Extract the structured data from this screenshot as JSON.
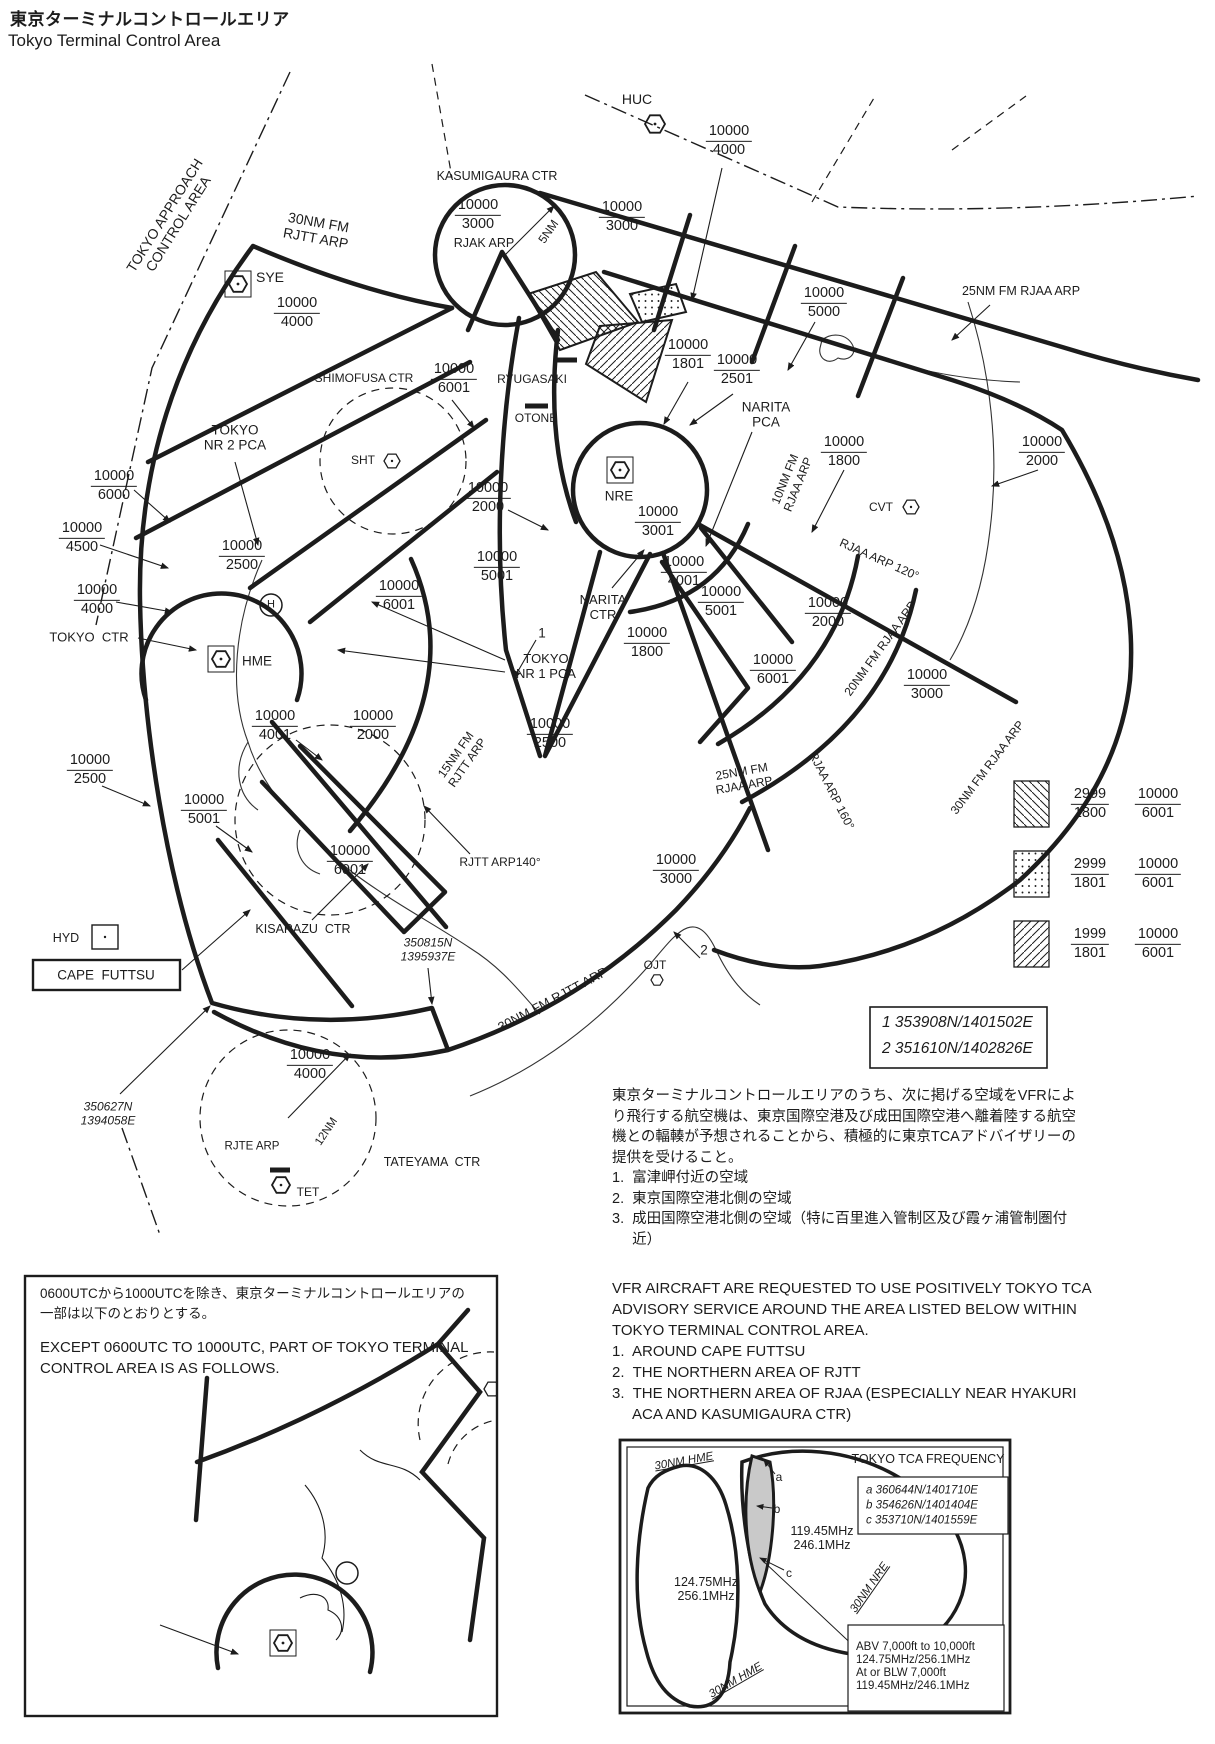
{
  "title": {
    "ja": "東京ターミナルコントロールエリア",
    "en": "Tokyo Terminal Control Area"
  },
  "colors": {
    "ink": "#1c1c1c",
    "shaded_area": "#c9c9c9",
    "background": "#ffffff"
  },
  "notes": {
    "ja": "東京ターミナルコントロールエリアのうち、次に掲げる空域をVFRによ\nり飛行する航空機は、東京国際空港及び成田国際空港へ離着陸する航空\n機との輻輳が予想されることから、積極的に東京TCAアドバイザリーの\n提供を受けること。\n1.  富津岬付近の空域\n2.  東京国際空港北側の空域\n3.  成田国際空港北側の空域（特に百里進入管制区及び霞ヶ浦管制圏付\n     近）",
    "en": "VFR AIRCRAFT ARE REQUESTED TO USE POSITIVELY TOKYO TCA\nADVISORY SERVICE AROUND THE AREA LISTED BELOW WITHIN\nTOKYO TERMINAL CONTROL AREA.\n1.  AROUND CAPE FUTTSU\n2.  THE NORTHERN AREA OF RJTT\n3.  THE NORTHERN AREA OF RJAA (ESPECIALLY NEAR HYAKURI\n     ACA AND KASUMIGAURA CTR)"
  },
  "coord_box": {
    "line1": "1 353908N/1401502E",
    "line2": "2 351610N/1402826E"
  },
  "legend": {
    "rows": [
      {
        "pattern": "backslash-hatch",
        "l": {
          "top": "2999",
          "bot": "1800"
        },
        "r": {
          "top": "10000",
          "bot": "6001"
        }
      },
      {
        "pattern": "dots",
        "l": {
          "top": "2999",
          "bot": "1801"
        },
        "r": {
          "top": "10000",
          "bot": "6001"
        }
      },
      {
        "pattern": "slash-hatch",
        "l": {
          "top": "1999",
          "bot": "1801"
        },
        "r": {
          "top": "10000",
          "bot": "6001"
        }
      }
    ]
  },
  "map": {
    "labels": [
      {
        "id": "label-tokyo-approach-control-area",
        "t": "TOKYO APPROACH\nCONTROL AREA",
        "x": 172,
        "y": 220,
        "rot": -58,
        "fs": 14
      },
      {
        "id": "label-30nm-fm-rjtt-arp-top",
        "t": "30NM FM\nRJTT ARP",
        "x": 317,
        "y": 231,
        "rot": 10,
        "fs": 14
      },
      {
        "id": "label-kasumigaura-ctr",
        "t": "KASUMIGAURA CTR",
        "x": 497,
        "y": 176,
        "fs": 12.5
      },
      {
        "id": "label-huc",
        "t": "HUC",
        "x": 637,
        "y": 100,
        "fs": 14
      },
      {
        "id": "label-rjak-arp",
        "t": "RJAK ARP",
        "x": 484,
        "y": 243,
        "fs": 12.5
      },
      {
        "id": "label-5nm",
        "t": "5NM",
        "x": 549,
        "y": 232,
        "rot": -55,
        "fs": 12
      },
      {
        "id": "label-25nm-fm-rjaa-arp-top",
        "t": "25NM FM RJAA ARP",
        "x": 1021,
        "y": 291,
        "fs": 12.5
      },
      {
        "id": "label-sye",
        "t": "SYE",
        "x": 270,
        "y": 278,
        "fs": 14
      },
      {
        "id": "label-shimofusa-ctr",
        "t": "SHIMOFUSA CTR",
        "x": 364,
        "y": 379,
        "fs": 12
      },
      {
        "id": "label-ryugasaki",
        "t": "RYUGASAKI",
        "x": 532,
        "y": 380,
        "fs": 12
      },
      {
        "id": "label-otone",
        "t": "OTONE",
        "x": 536,
        "y": 419,
        "fs": 12
      },
      {
        "id": "label-narita-pca",
        "t": "NARITA\nPCA",
        "x": 766,
        "y": 415,
        "fs": 13.5
      },
      {
        "id": "label-tokyo-nr-2-pca",
        "t": "TOKYO\nNR 2 PCA",
        "x": 235,
        "y": 438,
        "fs": 13.5
      },
      {
        "id": "label-sht",
        "t": "SHT",
        "x": 363,
        "y": 461,
        "fs": 12
      },
      {
        "id": "label-nre",
        "t": "NRE",
        "x": 619,
        "y": 496,
        "fs": 13.5
      },
      {
        "id": "label-10nm-fm-rjaa-arp",
        "t": "10NM FM\nRJAA ARP",
        "x": 792,
        "y": 482,
        "rot": -68,
        "fs": 12
      },
      {
        "id": "label-cvt",
        "t": "CVT",
        "x": 881,
        "y": 508,
        "fs": 12
      },
      {
        "id": "label-rjaa-arp-120",
        "t": "RJAA ARP 120°",
        "x": 879,
        "y": 560,
        "rot": 24,
        "fs": 12
      },
      {
        "id": "label-tokyo-ctr",
        "t": "TOKYO  CTR",
        "x": 89,
        "y": 638,
        "fs": 13
      },
      {
        "id": "label-hme",
        "t": "HME",
        "x": 257,
        "y": 661,
        "fs": 13.5
      },
      {
        "id": "label-narita-ctr",
        "t": "NARITA\nCTR",
        "x": 603,
        "y": 608,
        "fs": 13
      },
      {
        "id": "label-point-1",
        "t": "1",
        "x": 542,
        "y": 633,
        "fs": 13.5
      },
      {
        "id": "label-tokyo-nr-1-pca",
        "t": "TOKYO\nNR 1 PCA",
        "x": 546,
        "y": 667,
        "fs": 13
      },
      {
        "id": "label-15nm-fm-rjtt-arp",
        "t": "15NM FM\nRJTT ARP",
        "x": 462,
        "y": 759,
        "rot": -55,
        "fs": 12
      },
      {
        "id": "label-20nm-fm-rjaa-arp",
        "t": "20NM FM RJAA ARP",
        "x": 881,
        "y": 649,
        "rot": -54,
        "fs": 12
      },
      {
        "id": "label-25nm-fm-rjaa-arp",
        "t": "25NM FM\nRJAA ARP",
        "x": 743,
        "y": 779,
        "rot": -10,
        "fs": 12
      },
      {
        "id": "label-rjaa-arp-160",
        "t": "RJAA ARP 160°",
        "x": 831,
        "y": 791,
        "rot": 63,
        "fs": 12
      },
      {
        "id": "label-30nm-fm-rjaa-arp",
        "t": "30NM FM RJAA ARP",
        "x": 988,
        "y": 768,
        "rot": -53,
        "fs": 12
      },
      {
        "id": "label-rjtt-arp140",
        "t": "RJTT ARP140°",
        "x": 500,
        "y": 863,
        "fs": 12
      },
      {
        "id": "label-kisarazu-ctr",
        "t": "KISARAZU  CTR",
        "x": 303,
        "y": 929,
        "fs": 12.5
      },
      {
        "id": "label-hyd",
        "t": "HYD",
        "x": 66,
        "y": 938,
        "fs": 12.5
      },
      {
        "id": "label-cape-futtsu",
        "t": "CAPE  FUTTSU",
        "x": 106,
        "y": 975,
        "fs": 13.5
      },
      {
        "id": "label-coord-350815n",
        "t": "350815N\n1395937E",
        "x": 428,
        "y": 950,
        "fs": 12,
        "italic": 1
      },
      {
        "id": "label-ojt",
        "t": "OJT",
        "x": 655,
        "y": 966,
        "fs": 12
      },
      {
        "id": "label-point-2",
        "t": "2",
        "x": 704,
        "y": 950,
        "fs": 13.5
      },
      {
        "id": "label-coord-350627n",
        "t": "350627N\n1394058E",
        "x": 108,
        "y": 1114,
        "fs": 12,
        "italic": 1
      },
      {
        "id": "label-30nm-fm-rjtt-arp-bottom",
        "t": "30NM FM RJTT ARP",
        "x": 553,
        "y": 1000,
        "rot": -28,
        "fs": 13
      },
      {
        "id": "label-12nm",
        "t": "12NM",
        "x": 327,
        "y": 1132,
        "rot": -56,
        "fs": 11.5
      },
      {
        "id": "label-rjte-arp",
        "t": "RJTE ARP",
        "x": 252,
        "y": 1147,
        "fs": 11.5
      },
      {
        "id": "label-tateyama-ctr",
        "t": "TATEYAMA  CTR",
        "x": 432,
        "y": 1162,
        "fs": 12.5
      },
      {
        "id": "label-tet",
        "t": "TET",
        "x": 308,
        "y": 1193,
        "fs": 12
      },
      {
        "id": "label-heliport-h",
        "t": "H",
        "x": 271,
        "y": 605,
        "fs": 11
      }
    ],
    "fractions": [
      {
        "top": "10000",
        "bot": "4000",
        "x": 729,
        "y": 141
      },
      {
        "top": "10000",
        "bot": "3000",
        "x": 478,
        "y": 215
      },
      {
        "top": "10000",
        "bot": "3000",
        "x": 622,
        "y": 217
      },
      {
        "top": "10000",
        "bot": "5000",
        "x": 824,
        "y": 303
      },
      {
        "top": "10000",
        "bot": "4000",
        "x": 297,
        "y": 313
      },
      {
        "top": "10000",
        "bot": "1801",
        "x": 688,
        "y": 355
      },
      {
        "top": "10000",
        "bot": "2501",
        "x": 737,
        "y": 370
      },
      {
        "top": "10000",
        "bot": "6001",
        "x": 454,
        "y": 379
      },
      {
        "top": "10000",
        "bot": "1800",
        "x": 844,
        "y": 452
      },
      {
        "top": "10000",
        "bot": "2000",
        "x": 1042,
        "y": 452
      },
      {
        "top": "10000",
        "bot": "6000",
        "x": 114,
        "y": 486
      },
      {
        "top": "10000",
        "bot": "2000",
        "x": 488,
        "y": 498
      },
      {
        "top": "10000",
        "bot": "4500",
        "x": 82,
        "y": 538
      },
      {
        "top": "10000",
        "bot": "2500",
        "x": 242,
        "y": 556
      },
      {
        "top": "10000",
        "bot": "5001",
        "x": 497,
        "y": 567
      },
      {
        "top": "10000",
        "bot": "6001",
        "x": 399,
        "y": 596
      },
      {
        "top": "10000",
        "bot": "4000",
        "x": 97,
        "y": 600
      },
      {
        "top": "10000",
        "bot": "3001",
        "x": 658,
        "y": 522
      },
      {
        "top": "10000",
        "bot": "4001",
        "x": 684,
        "y": 572
      },
      {
        "top": "10000",
        "bot": "5001",
        "x": 721,
        "y": 602
      },
      {
        "top": "10000",
        "bot": "2000",
        "x": 828,
        "y": 613
      },
      {
        "top": "10000",
        "bot": "6001",
        "x": 773,
        "y": 670
      },
      {
        "top": "10000",
        "bot": "3000",
        "x": 927,
        "y": 685
      },
      {
        "top": "10000",
        "bot": "1800",
        "x": 647,
        "y": 643
      },
      {
        "top": "10000",
        "bot": "2500",
        "x": 550,
        "y": 734
      },
      {
        "top": "10000",
        "bot": "4001",
        "x": 275,
        "y": 726
      },
      {
        "top": "10000",
        "bot": "2000",
        "x": 373,
        "y": 726
      },
      {
        "top": "10000",
        "bot": "2500",
        "x": 90,
        "y": 770
      },
      {
        "top": "10000",
        "bot": "5001",
        "x": 204,
        "y": 810
      },
      {
        "top": "10000",
        "bot": "6001",
        "x": 350,
        "y": 861
      },
      {
        "top": "10000",
        "bot": "3000",
        "x": 676,
        "y": 870
      },
      {
        "top": "10000",
        "bot": "4000",
        "x": 310,
        "y": 1065
      }
    ]
  },
  "inset": {
    "note_ja": "0600UTCから1000UTCを除き、東京ターミナルコントロールエリアの\n一部は以下のとおりとする。",
    "note_en": "EXCEPT 0600UTC TO 1000UTC, PART OF TOKYO TERMINAL\nCONTROL AREA IS AS FOLLOWS.",
    "labels": [
      {
        "id": "inset-label-sht",
        "t": "SHT",
        "x": 433,
        "y": 116,
        "fs": 12
      },
      {
        "id": "inset-label-tokyo-ctr",
        "t": "TOKYO CTR",
        "x": 100,
        "y": 344,
        "fs": 13
      },
      {
        "id": "inset-label-hme",
        "t": "HME",
        "x": 303,
        "y": 371,
        "fs": 13.5
      },
      {
        "id": "inset-label-heliport-h",
        "t": "H",
        "x": 322,
        "y": 297,
        "fs": 11
      }
    ],
    "fractions": [
      {
        "top": "10000",
        "bot": "4000",
        "x": 265,
        "y": 158
      },
      {
        "top": "10000",
        "bot": "2500",
        "x": 210,
        "y": 266
      },
      {
        "top": "10000",
        "bot": "6001",
        "x": 491,
        "y": 270
      }
    ]
  },
  "freq_box": {
    "labels": [
      {
        "id": "freq-box-title",
        "t": "TOKYO TCA FREQUENCY",
        "x": 928,
        "y": 1459,
        "fs": 12.5
      },
      {
        "id": "freq-label-30nm-hme-top",
        "t": "30NM HME",
        "x": 684,
        "y": 1462,
        "rot": -10,
        "fs": 11.5,
        "italic": 1,
        "cls": "und"
      },
      {
        "id": "freq-coord-a",
        "t": "a 360644N/1401710E",
        "x": 866,
        "y": 1491,
        "fs": 11.5,
        "italic": 1,
        "left": 1
      },
      {
        "id": "freq-coord-b",
        "t": "b 354626N/1401404E",
        "x": 866,
        "y": 1506,
        "fs": 11.5,
        "italic": 1,
        "left": 1
      },
      {
        "id": "freq-coord-c",
        "t": "c 353710N/1401559E",
        "x": 866,
        "y": 1521,
        "fs": 11.5,
        "italic": 1,
        "left": 1
      },
      {
        "id": "freq-marker-a",
        "t": "a",
        "x": 779,
        "y": 1478,
        "fs": 12
      },
      {
        "id": "freq-marker-b",
        "t": "b",
        "x": 777,
        "y": 1510,
        "fs": 12
      },
      {
        "id": "freq-marker-c",
        "t": "c",
        "x": 789,
        "y": 1574,
        "fs": 12
      },
      {
        "id": "freq-value-northeast",
        "t": "119.45MHz\n246.1MHz",
        "x": 822,
        "y": 1538,
        "fs": 12.5
      },
      {
        "id": "freq-value-west",
        "t": "124.75MHz\n256.1MHz",
        "x": 706,
        "y": 1589,
        "fs": 12.5
      },
      {
        "id": "freq-label-30nm-nre",
        "t": "30NM NRE",
        "x": 870,
        "y": 1588,
        "rot": -55,
        "fs": 11.5,
        "italic": 1,
        "cls": "und"
      },
      {
        "id": "freq-label-30nm-hme-bottom",
        "t": "30NM HME",
        "x": 736,
        "y": 1681,
        "rot": -30,
        "fs": 11.5,
        "italic": 1,
        "cls": "und"
      },
      {
        "id": "freq-altitude-note",
        "t": "ABV 7,000ft to 10,000ft\n124.75MHz/256.1MHz\nAt or BLW 7,000ft\n119.45MHz/246.1MHz",
        "x": 856,
        "y": 1667,
        "fs": 11.5,
        "left": 1
      }
    ]
  }
}
